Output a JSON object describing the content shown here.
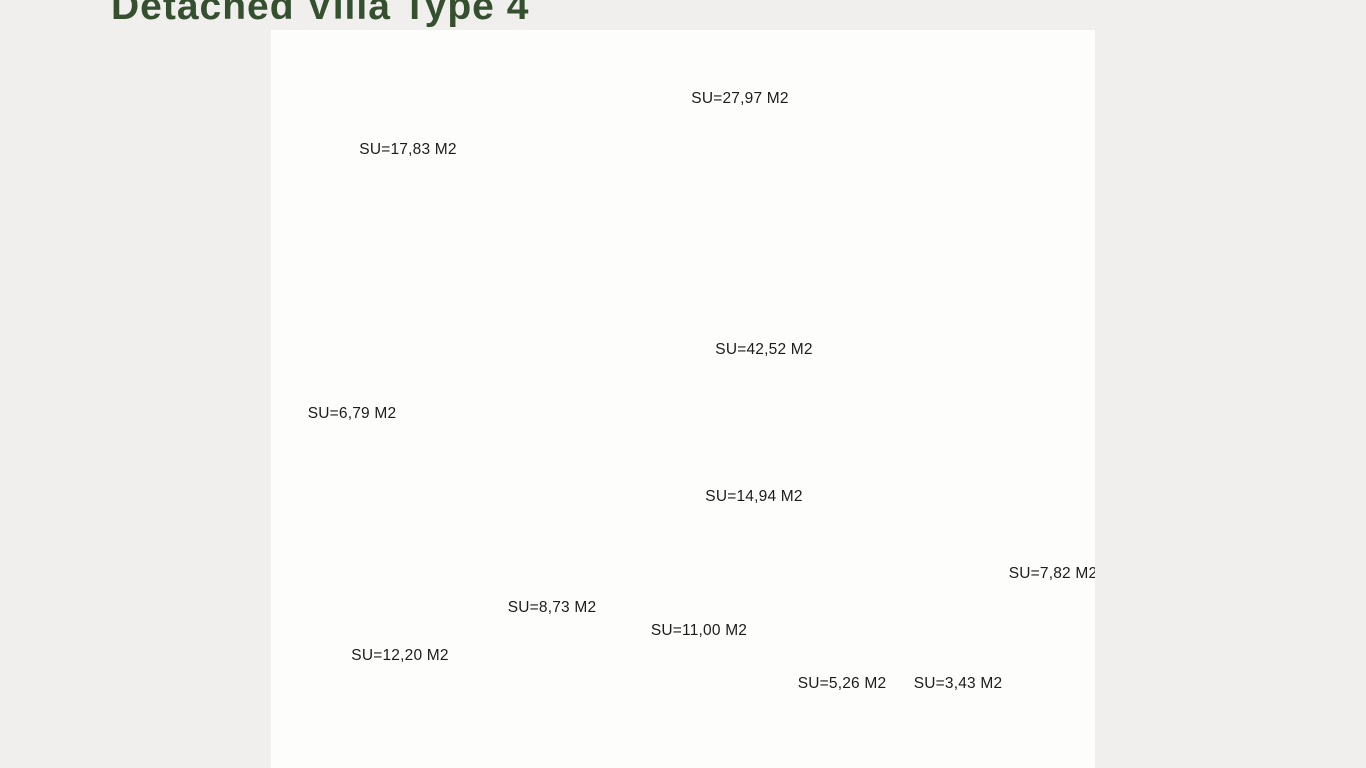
{
  "title": {
    "text": "Detached Villa Type 4",
    "color": "#35502f"
  },
  "plan": {
    "unit": "M2",
    "rooms": [
      {
        "id": "bedroom-1",
        "name": "master bedroom",
        "label": "SU=17,83 M2"
      },
      {
        "id": "terrace",
        "name": "terrace dining",
        "label": "SU=27,97 M2"
      },
      {
        "id": "living",
        "name": "living-kitchen",
        "label": "SU=42,52 M2"
      },
      {
        "id": "bathroom-1",
        "name": "laundry bathroom",
        "label": "SU=6,79 M2"
      },
      {
        "id": "hallway",
        "name": "hallway",
        "label": "SU=14,94 M2"
      },
      {
        "id": "bathroom-2",
        "name": "family bathroom",
        "label": "SU=8,73 M2"
      },
      {
        "id": "bedroom-2",
        "name": "bedroom",
        "label": "SU=12,20 M2"
      },
      {
        "id": "bedroom-3",
        "name": "twin bedroom",
        "label": "SU=11,00 M2"
      },
      {
        "id": "closet",
        "name": "dressing closet",
        "label": "SU=5,26 M2"
      },
      {
        "id": "bathroom-3",
        "name": "guest toilet",
        "label": "SU=3,43 M2"
      },
      {
        "id": "entry",
        "name": "entry porch",
        "label": "SU=7,82 M2"
      }
    ],
    "colors": {
      "wall": "#2b2b2b",
      "furniture_line": "#b8b8b8",
      "window_line": "#8a8a8a",
      "boundary_dash": "#a0a0a0",
      "sheet": "#fdfdfb",
      "page_background": "#f0efed",
      "label_text": "#1c1c1c"
    }
  }
}
